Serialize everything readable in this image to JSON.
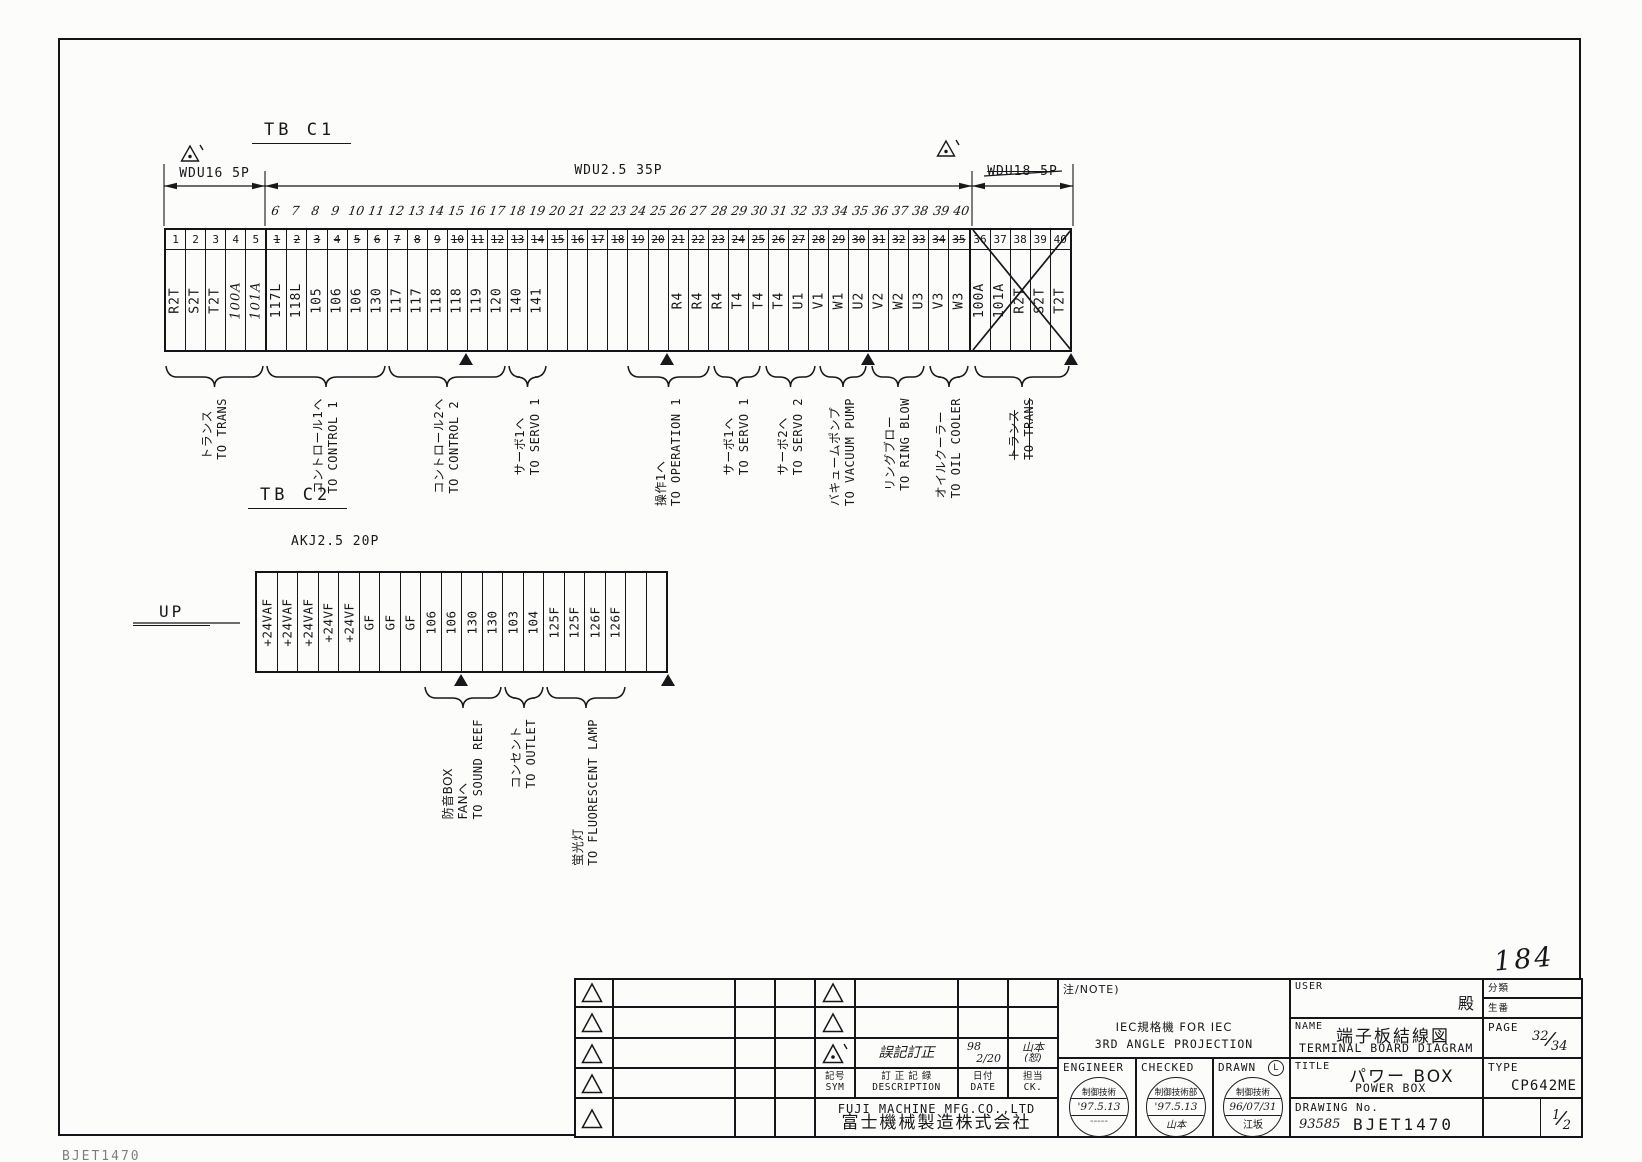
{
  "tb_c1": {
    "title": "TB C1",
    "dim_segments": [
      {
        "label": "WDU16 5P",
        "struck": false
      },
      {
        "label": "WDU2.5 35P",
        "struck": false
      },
      {
        "label": "WDU18 5P",
        "struck": true
      }
    ],
    "printed_numbers": [
      "1",
      "2",
      "3",
      "4",
      "5",
      "1",
      "2",
      "3",
      "4",
      "5",
      "6",
      "7",
      "8",
      "9",
      "10",
      "11",
      "12",
      "13",
      "14",
      "15",
      "16",
      "17",
      "18",
      "19",
      "20",
      "21",
      "22",
      "23",
      "24",
      "25",
      "26",
      "27",
      "28",
      "29",
      "30",
      "31",
      "32",
      "33",
      "34",
      "35",
      "36",
      "37",
      "38",
      "39",
      "40"
    ],
    "handwritten_numbers": [
      "",
      "",
      "",
      "",
      "",
      "6",
      "7",
      "8",
      "9",
      "10",
      "11",
      "12",
      "13",
      "14",
      "15",
      "16",
      "17",
      "18",
      "19",
      "20",
      "21",
      "22",
      "23",
      "24",
      "25",
      "26",
      "27",
      "28",
      "29",
      "30",
      "31",
      "32",
      "33",
      "34",
      "35",
      "36",
      "37",
      "38",
      "39",
      "40",
      "",
      "",
      "",
      "",
      ""
    ],
    "labels": [
      "R2T",
      "S2T",
      "T2T",
      "100A",
      "101A",
      "117L",
      "118L",
      "105",
      "106",
      "106",
      "130",
      "117",
      "117",
      "118",
      "118",
      "119",
      "120",
      "140",
      "141",
      "",
      "",
      "",
      "",
      "",
      "",
      "R4",
      "R4",
      "R4",
      "T4",
      "T4",
      "T4",
      "U1",
      "V1",
      "W1",
      "U2",
      "V2",
      "W2",
      "U3",
      "V3",
      "W3",
      "100A",
      "101A",
      "R2T",
      "S2T",
      "T2T"
    ],
    "groups": [
      {
        "jp": "トランス",
        "en": "TO TRANS",
        "struck": false
      },
      {
        "jp": "コントロール1ヘ",
        "en": "TO CONTROL 1",
        "struck": false
      },
      {
        "jp": "コントロール2ヘ",
        "en": "TO CONTROL 2",
        "struck": false
      },
      {
        "jp": "サーボ1ヘ",
        "en": "TO SERVO 1",
        "struck": false
      },
      {
        "jp": "操作1ヘ",
        "en": "TO OPERATION 1",
        "struck": false
      },
      {
        "jp": "サーボ1ヘ",
        "en": "TO SERVO 1",
        "struck": false
      },
      {
        "jp": "サーボ2ヘ",
        "en": "TO SERVO 2",
        "struck": false
      },
      {
        "jp": "バキュームポンプ",
        "en": "TO VACUUM PUMP",
        "struck": false
      },
      {
        "jp": "リングブロー",
        "en": "TO RING BLOW",
        "struck": false
      },
      {
        "jp": "オイルクーラー",
        "en": "TO OIL COOLER",
        "struck": false
      },
      {
        "jp": "トランス",
        "en": "TO TRANS",
        "struck": true
      }
    ]
  },
  "tb_c2": {
    "title": "TB C2",
    "connector_label": "AKJ2.5 20P",
    "up_label": "UP",
    "labels": [
      "+24VAF",
      "+24VAF",
      "+24VAF",
      "+24VF",
      "+24VF",
      "GF",
      "GF",
      "GF",
      "106",
      "106",
      "130",
      "130",
      "103",
      "104",
      "125F",
      "125F",
      "126F",
      "126F",
      "",
      ""
    ],
    "groups": [
      {
        "lines": [
          "防音BOX",
          "FANヘ",
          "TO SOUND REEF"
        ],
        "struck": false
      },
      {
        "lines": [
          "コンセント",
          "TO OUTLET"
        ],
        "struck": false
      },
      {
        "lines": [
          "蛍光灯",
          "TO FLUORESCENT LAMP"
        ],
        "struck": false
      }
    ]
  },
  "title_block": {
    "note_label": "注/NOTE)",
    "projection_line1": "IEC規格機  FOR IEC",
    "projection_line2": "3RD ANGLE PROJECTION",
    "user_label": "USER",
    "user_honorific": "殿",
    "class_label": "分類",
    "series_label": "生番",
    "name_label": "NAME",
    "name_jp": "端子板結線図",
    "name_en": "TERMINAL BOARD DIAGRAM",
    "page_label": "PAGE",
    "page_value": "32",
    "page_total": "34",
    "fraction_slash": "/",
    "title_label": "TITLE",
    "title_jp": "パワー BOX",
    "title_en": "POWER BOX",
    "type_label": "TYPE",
    "type_value": "CP642ME",
    "drawing_no_label": "DRAWING No.",
    "drawing_no_hand": "93585",
    "drawing_no": "BJET1470",
    "sheet_value": "1",
    "sheet_total": "2",
    "engineer_label": "ENGINEER",
    "checked_label": "CHECKED",
    "drawn_label": "DRAWN",
    "drawn_mark": "L",
    "stamps": {
      "engineer": {
        "line1": "制御技術",
        "line2": "'97.5.13",
        "line3": "-----"
      },
      "checked": {
        "line1": "制御技術部",
        "line2": "'97.5.13",
        "line3": "山本"
      },
      "drawn": {
        "line1": "制御技術",
        "line2": "96/07/31",
        "line3": "江坂"
      }
    }
  },
  "revision_table": {
    "header": {
      "sym_jp": "記号",
      "sym_en": "SYM",
      "desc_jp": "訂 正 記 録",
      "desc_en": "DESCRIPTION",
      "date_jp": "日付",
      "date_en": "DATE",
      "ck_jp": "担当",
      "ck_en": "CK."
    },
    "rows": [
      {
        "sym": "triangle",
        "desc": "",
        "date_top": "",
        "date_bottom": "",
        "ck_top": "",
        "ck_bottom": ""
      },
      {
        "sym": "triangle",
        "desc": "",
        "date_top": "",
        "date_bottom": "",
        "ck_top": "",
        "ck_bottom": ""
      },
      {
        "sym": "triangle-prime",
        "desc": "誤記訂正",
        "date_top": "98",
        "date_bottom": "2/20",
        "ck_top": "山本",
        "ck_bottom": "(恕)"
      }
    ],
    "left_empty_rows": 5,
    "company_en": "FUJI MACHINE MFG.CO.,LTD",
    "company_jp": "富士機械製造株式会社"
  },
  "misc": {
    "hand_number": "184",
    "corner_code": "BJET1470"
  }
}
